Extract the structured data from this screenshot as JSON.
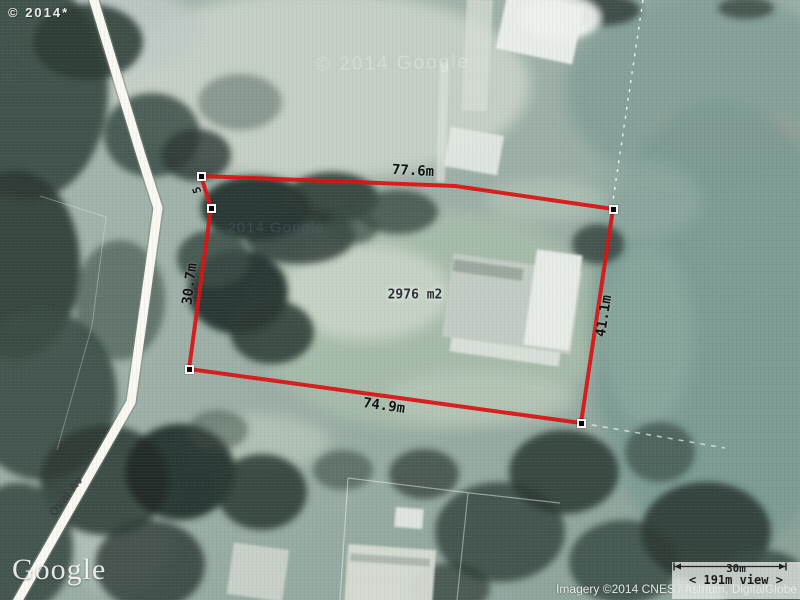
{
  "colors": {
    "parcel_outline": "#dc1111",
    "vertex_marker_fill": "#000000",
    "vertex_marker_border": "#ffffff",
    "road": "#faf8f2",
    "measurement_text": "#111111"
  },
  "map": {
    "copyright_top_left": "© 2014*",
    "watermark_top": "© 2014 Google",
    "watermark_inner": "2014 Google",
    "logo": "Google",
    "street_label": "Oval Av",
    "attribution": "Imagery ©2014 CNES / Astrium, DigitalGlobe"
  },
  "parcel": {
    "area_label": "2976 m2",
    "outline_points": "201,176 455,186 613,209 581,423 189,369 211,208",
    "edge_labels": {
      "top": "77.6m",
      "bottom": "74.9m",
      "right": "41.1m",
      "left": "30.7m",
      "left_short": "5"
    }
  },
  "scalebar": {
    "distance": "30m",
    "view": "< 191m view >"
  }
}
